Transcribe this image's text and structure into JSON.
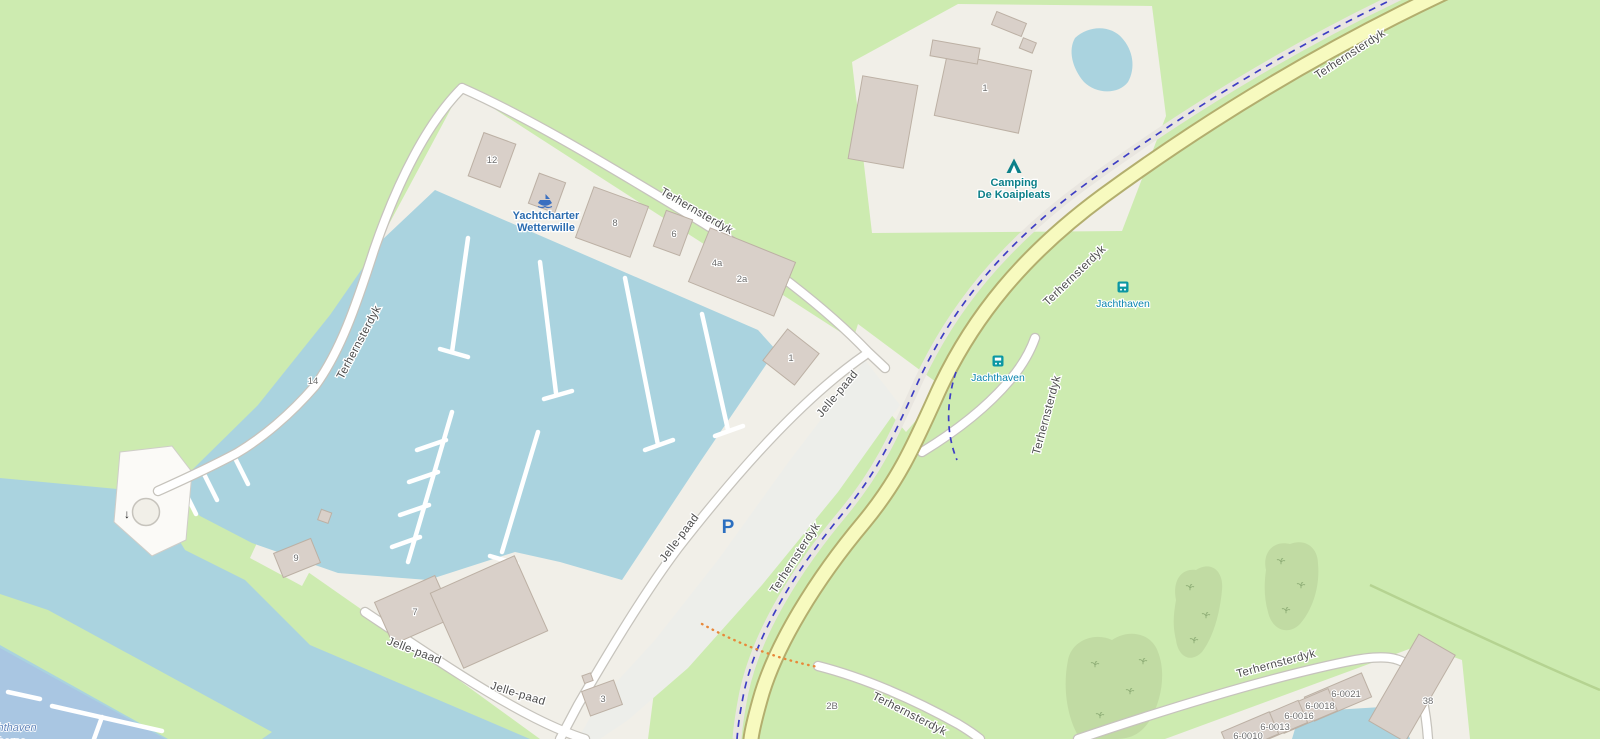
{
  "colors": {
    "land": "#cdebb0",
    "water": "#aad3df",
    "harbor_water": "#a9c6e2",
    "yard": "#f1efe8",
    "campground": "#f1efe8",
    "parking": "#edeeea",
    "building": "#d9d0c9",
    "building_outline": "#bcb0a4",
    "road_white": "#ffffff",
    "road_casing": "#c6c3bc",
    "road_yellow": "#f7fabf",
    "road_yellow_casing": "#b3ae6e",
    "cycleway_band": "#e9e6e0",
    "cycleway_dash": "#3d3dc4",
    "scrub": "#c1dba3",
    "scrub_symbol": "#8fae77",
    "pier": "#ffffff",
    "hedge": "#b5d391",
    "path_dotted": "#e8883a",
    "label_road": "#4d4d4d",
    "label_house": "#6d6d6d",
    "label_poi": "#2b6cb0",
    "label_leisure": "#0c8089",
    "label_transit": "#0a85ad",
    "label_water": "#6286bb",
    "parking_symbol_color": "#2b6fc0"
  },
  "road_labels": {
    "r_top": {
      "text": "Terhernsterdyk"
    },
    "r_mid": {
      "text": "Terhernsterdyk"
    },
    "r_low": {
      "text": "Terhernsterdyk"
    },
    "r_white_top": {
      "text": "Terhernsterdyk"
    },
    "r_white_west": {
      "text": "Terhernsterdyk"
    },
    "r_branch": {
      "text": "Terhernsterdyk"
    },
    "r_r6": {
      "text": "Terhernsterdyk"
    },
    "r_r7": {
      "text": "Terhernsterdyk"
    },
    "j_d1": {
      "text": "Jelle-paad"
    },
    "j_d2": {
      "text": "Jelle-paad"
    },
    "j_b1": {
      "text": "Jelle-paad"
    },
    "j_b2": {
      "text": "Jelle-paad"
    }
  },
  "poi": {
    "yachtcharter": {
      "line1": "Yachtcharter",
      "line2": "Wetterwille"
    },
    "camping": {
      "line1": "Camping",
      "line2": "De Koaipleats"
    },
    "bus_stop_1": {
      "label": "Jachthaven"
    },
    "bus_stop_2": {
      "label": "Jachthaven"
    }
  },
  "house_numbers": {
    "h12": "12",
    "h8": "8",
    "h6": "6",
    "h4a": "4a",
    "h2a": "2a",
    "h1_marina": "1",
    "h1_camp": "1",
    "h14": "14",
    "h9": "9",
    "h7": "7",
    "h3": "3",
    "h2b": "2B",
    "h38": "38",
    "p21": "6-0021",
    "p18": "6-0018",
    "p16": "6-0016",
    "p13": "6-0013",
    "p10": "6-0010"
  },
  "water_label": {
    "line1": "chthaven",
    "line2": "erherne"
  },
  "parking": {
    "symbol": "P"
  }
}
